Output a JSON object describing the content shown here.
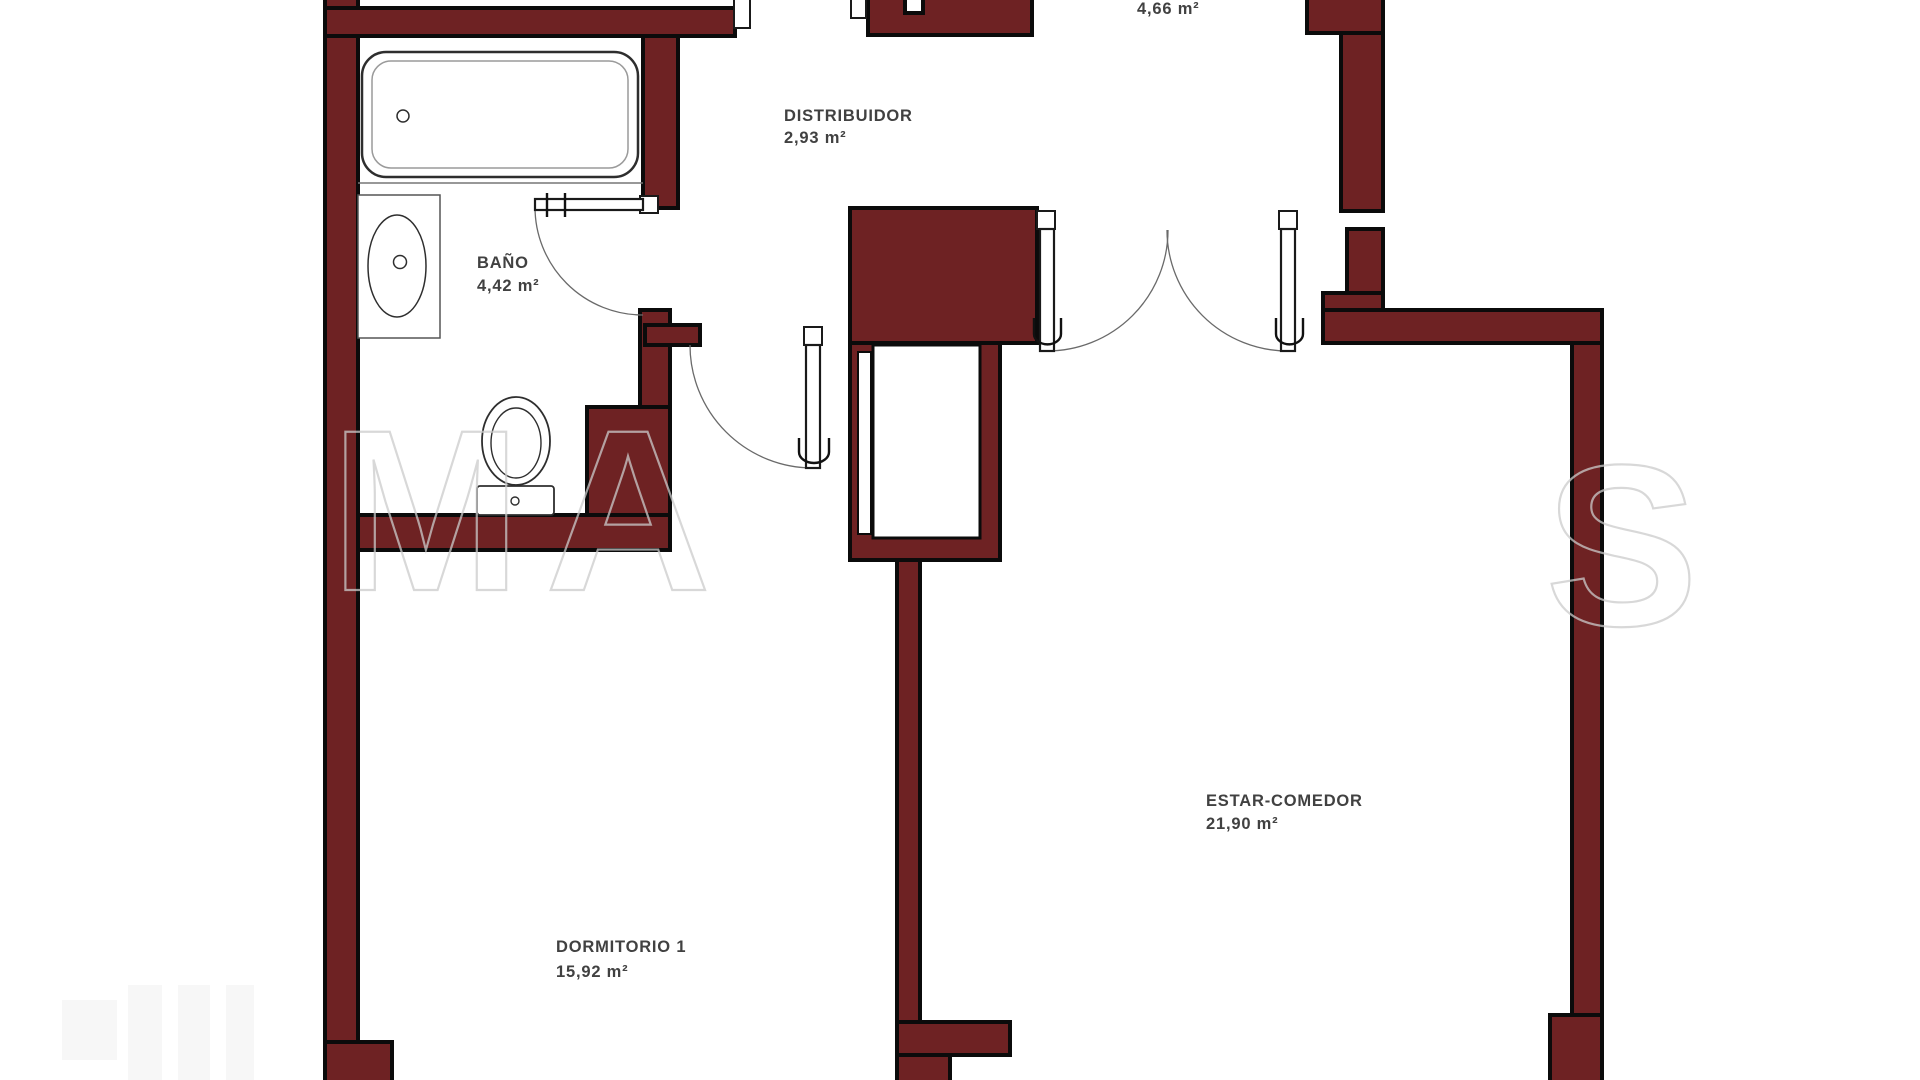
{
  "meta": {
    "type": "floor-plan",
    "language": "es"
  },
  "colors": {
    "background": "#ffffff",
    "wall_fill": "#6e2223",
    "wall_stroke": "#0b0b0b",
    "fixture_stroke": "#2e2e2e",
    "door_arc": "#6a6a6a",
    "label_color": "#414141",
    "watermark_color": "#cccccc"
  },
  "rooms": [
    {
      "id": "top-room",
      "name": "",
      "area": "4,66 m²"
    },
    {
      "id": "distribuidor",
      "name": "DISTRIBUIDOR",
      "area": "2,93 m²"
    },
    {
      "id": "bano",
      "name": "BAÑO",
      "area": "4,42 m²"
    },
    {
      "id": "dormitorio-1",
      "name": "DORMITORIO 1",
      "area": "15,92 m²"
    },
    {
      "id": "estar-comedor",
      "name": "ESTAR-COMEDOR",
      "area": "21,90 m²"
    }
  ],
  "watermark": {
    "letters": {
      "l1": "M",
      "l2": "A",
      "l3": "S"
    }
  }
}
